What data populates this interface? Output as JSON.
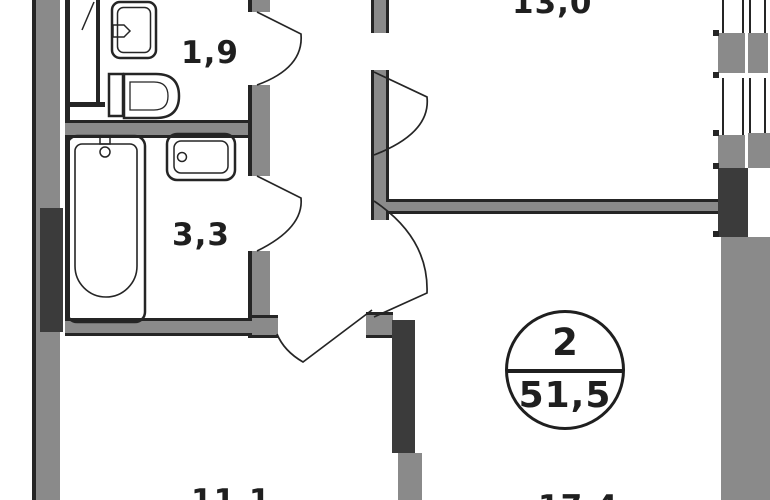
{
  "plan": {
    "title": "apartment-floor-plan",
    "rooms": {
      "wc_area": "1,9",
      "bathroom_area": "3,3",
      "kitchen_area": "13,0",
      "room_a_area": "11,1",
      "room_b_area": "17,4"
    },
    "stamp": {
      "room_count": "2",
      "total_area": "51,5"
    },
    "fixtures": [
      "sink",
      "toilet",
      "bathtub",
      "washbasin"
    ],
    "colors": {
      "bg": "#ffffff",
      "wall": "#8a8a8a",
      "wall_dark": "#3b3b3b",
      "line": "#252525",
      "text": "#1f1f1f"
    }
  }
}
